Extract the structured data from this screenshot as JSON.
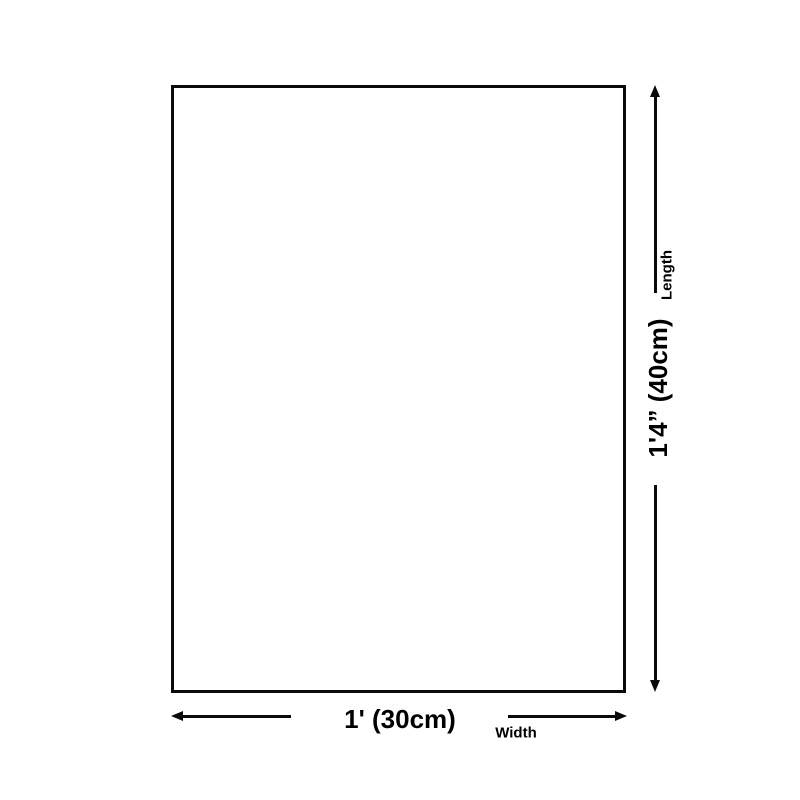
{
  "page": {
    "background_color": "#ffffff",
    "line_color": "#0a0a0a"
  },
  "diagram": {
    "shape": "rectangle-outline",
    "dimensions": {
      "length": {
        "value": "1'4” (40cm)",
        "label": "Length"
      },
      "width": {
        "value": "1' (30cm)",
        "label": "Width"
      }
    },
    "icons": {
      "vertical_arrow_top": "arrow-up",
      "vertical_arrow_bottom": "arrow-down",
      "horizontal_arrow_left": "arrow-left",
      "horizontal_arrow_right": "arrow-right"
    }
  }
}
